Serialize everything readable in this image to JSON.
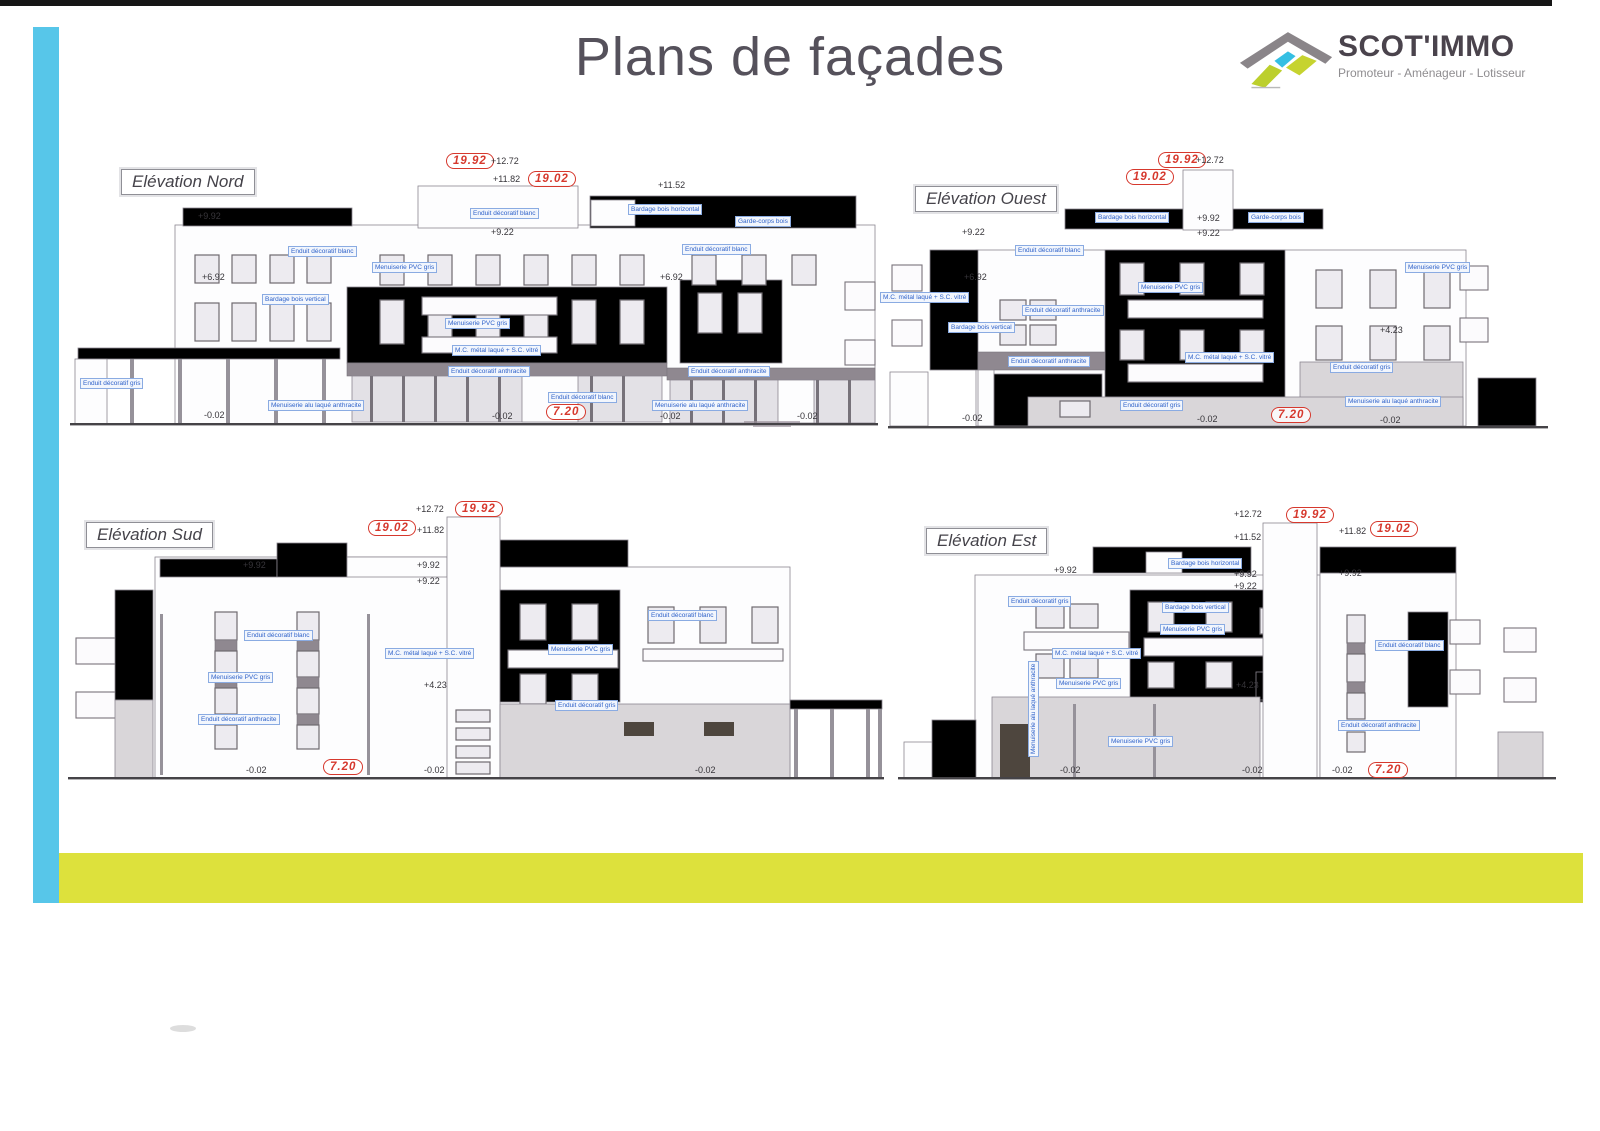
{
  "page": {
    "title": "Plans de façades",
    "logo": {
      "name": "SCOT'IMMO",
      "tagline": "Promoteur - Aménageur - Lotisseur"
    },
    "colors": {
      "stripe_blue": "#57c6e9",
      "stripe_yellow": "#dde13c",
      "annotation_red": "#d6382d",
      "material_label_blue": "#2f62c9",
      "wood_cladding": "#d5c99c",
      "anthracite_band": "#8f8890"
    }
  },
  "elevations": [
    {
      "name": "Elévation Nord",
      "ovals": [
        "19.92",
        "19.02",
        "7.20"
      ],
      "dims": [
        "+12.72",
        "+11.82",
        "+11.52",
        "+9.92",
        "+9.22",
        "+6.92",
        "+6.92",
        "-0.02",
        "-0.02",
        "-0.02",
        "-0.02"
      ],
      "materials": [
        "Enduit décoratif blanc",
        "Enduit décoratif blanc",
        "Bardage bois horizontal",
        "Garde-corps bois",
        "Enduit décoratif blanc",
        "Menuiserie PVC gris",
        "Bardage bois vertical",
        "Menuiserie PVC gris",
        "M.C. métal laqué + S.C. vitré",
        "Enduit décoratif anthracite",
        "Enduit décoratif anthracite",
        "Enduit décoratif blanc",
        "Menuiserie alu laqué anthracite",
        "Menuiserie alu laqué anthracite",
        "Enduit décoratif gris"
      ]
    },
    {
      "name": "Elévation Ouest",
      "ovals": [
        "19.92",
        "19.02",
        "7.20"
      ],
      "dims": [
        "+12.72",
        "+9.92",
        "+9.22",
        "+9.22",
        "+6.92",
        "+4.23",
        "-0.02",
        "-0.02",
        "-0.02"
      ],
      "materials": [
        "M.C. métal laqué + S.C. vitré",
        "Bardage bois vertical",
        "Enduit décoratif anthracite",
        "Enduit décoratif anthracite",
        "Enduit décoratif blanc",
        "Bardage bois horizontal",
        "Garde-corps bois",
        "Menuiserie PVC gris",
        "M.C. métal laqué + S.C. vitré",
        "Enduit décoratif gris",
        "Enduit décoratif gris",
        "Menuiserie alu laqué anthracite",
        "Menuiserie PVC gris"
      ]
    },
    {
      "name": "Elévation Sud",
      "ovals": [
        "19.92",
        "19.02",
        "7.20"
      ],
      "dims": [
        "+12.72",
        "+11.82",
        "+9.92",
        "+9.92",
        "+9.22",
        "+4.23",
        "-0.02",
        "-0.02",
        "-0.02"
      ],
      "materials": [
        "Enduit décoratif blanc",
        "Menuiserie PVC gris",
        "Enduit décoratif anthracite",
        "M.C. métal laqué + S.C. vitré",
        "Menuiserie PVC gris",
        "Enduit décoratif gris",
        "Enduit décoratif blanc"
      ]
    },
    {
      "name": "Elévation Est",
      "ovals": [
        "19.92",
        "19.02",
        "7.20"
      ],
      "dims": [
        "+12.72",
        "+11.52",
        "+11.82",
        "+9.92",
        "+9.92",
        "+9.22",
        "+9.92",
        "+4.23",
        "-0.02",
        "-0.02",
        "-0.02"
      ],
      "materials": [
        "Enduit décoratif gris",
        "Bardage bois horizontal",
        "Bardage bois vertical",
        "Menuiserie PVC gris",
        "M.C. métal laqué + S.C. vitré",
        "Menuiserie PVC gris",
        "Menuiserie PVC gris",
        "Enduit décoratif anthracite",
        "Enduit décoratif blanc",
        "Menuiserie alu laqué anthracite"
      ]
    }
  ]
}
